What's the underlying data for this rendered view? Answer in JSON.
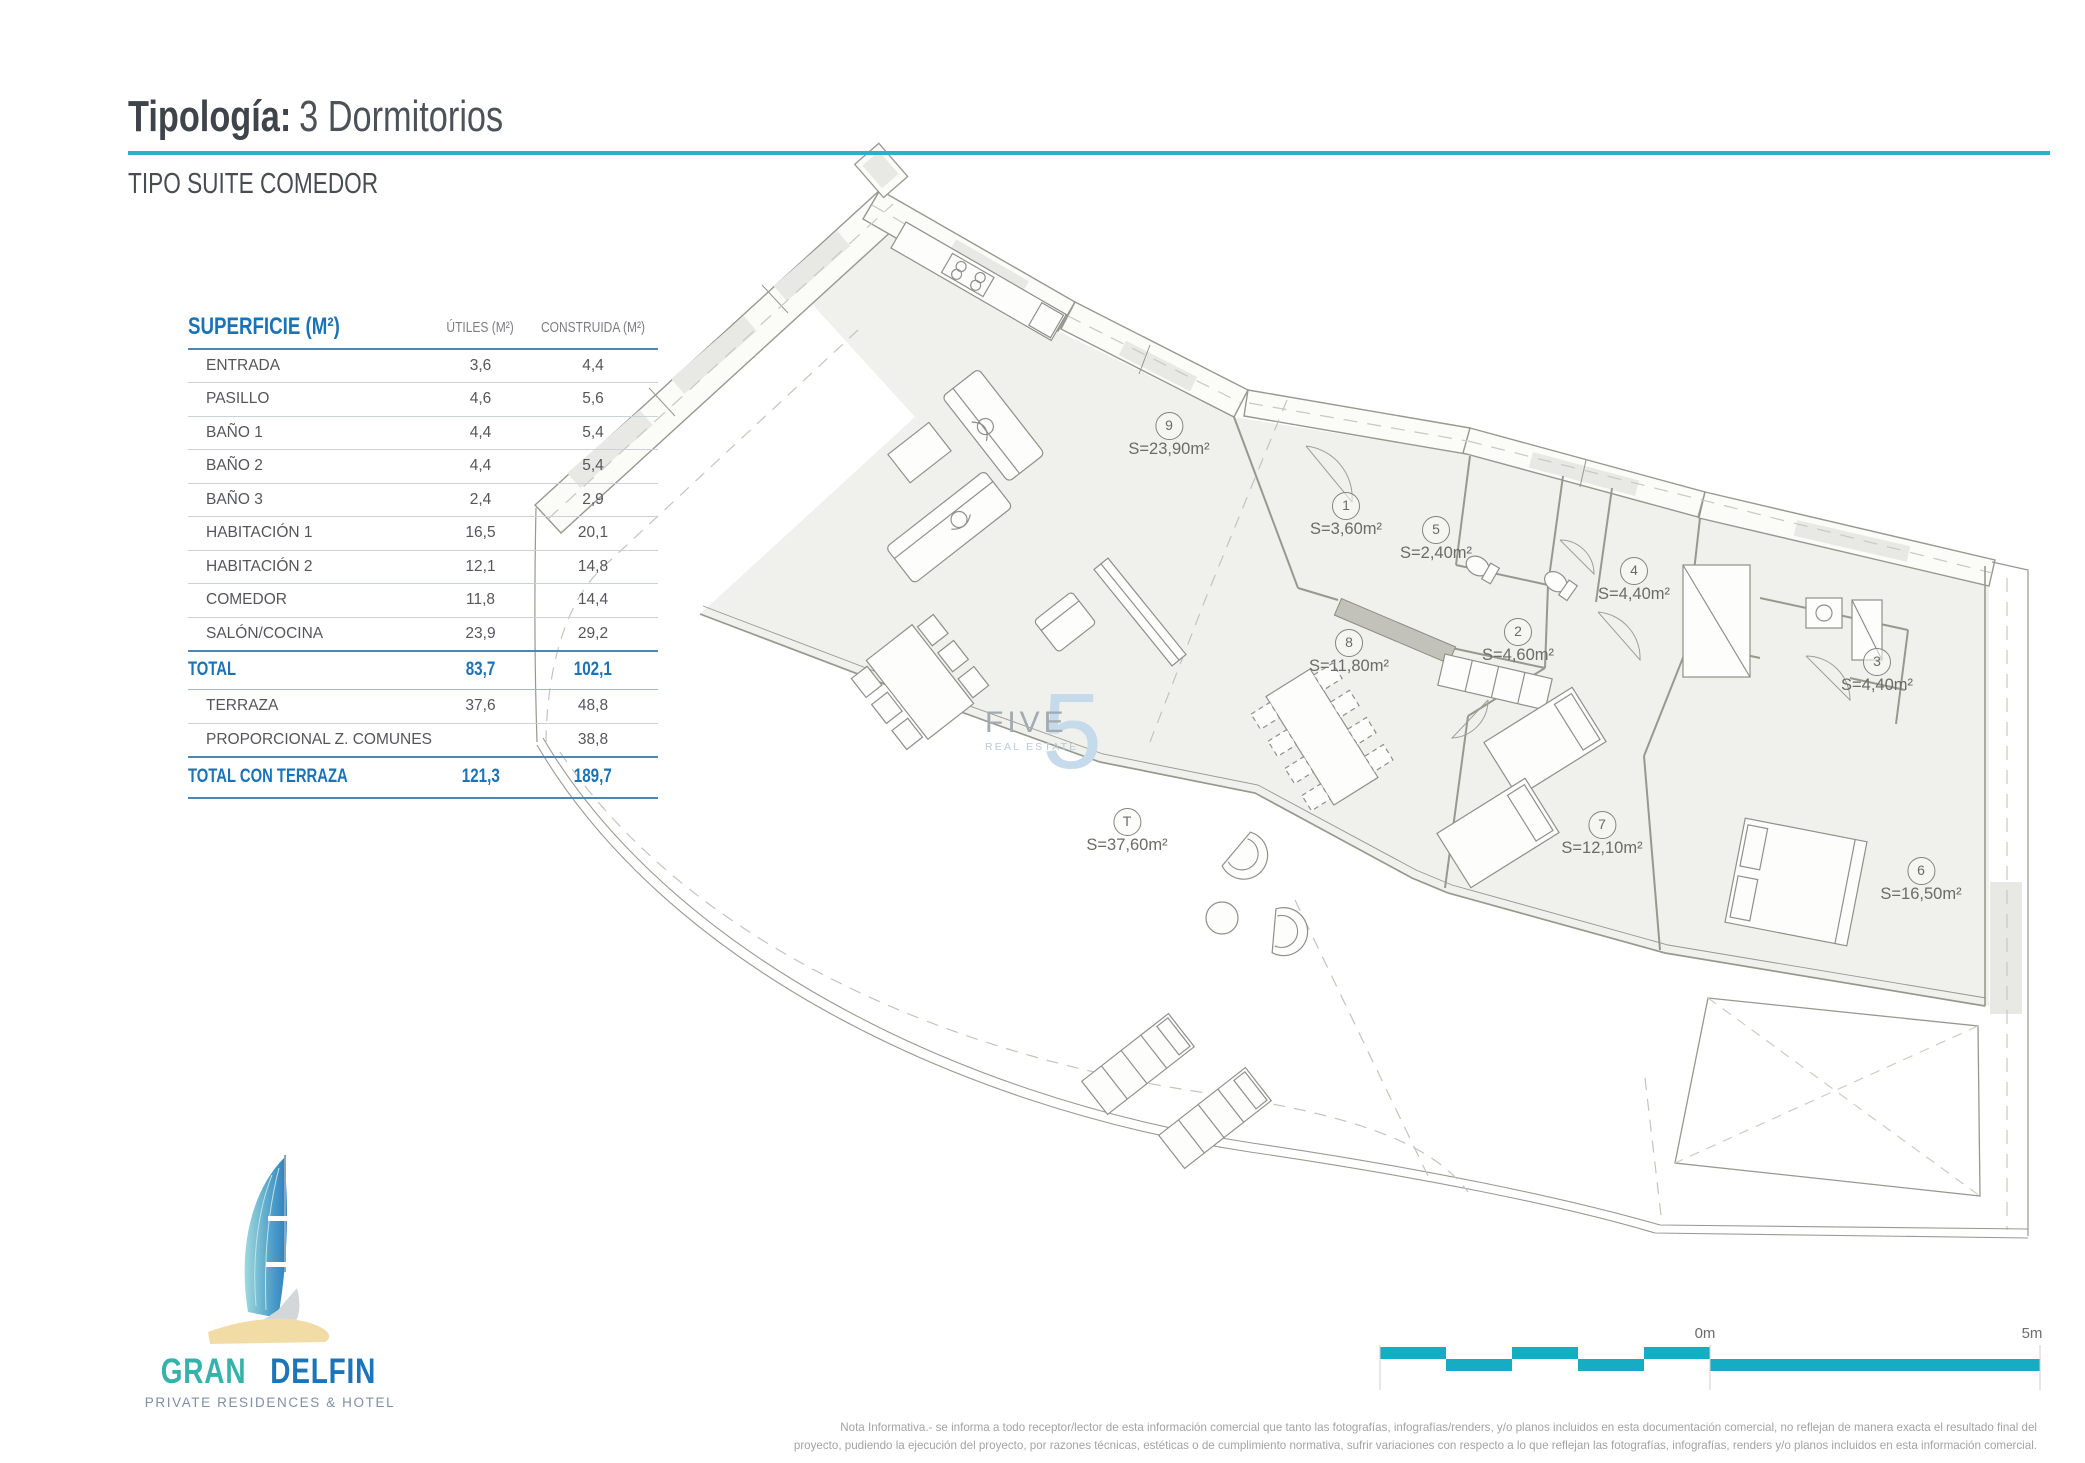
{
  "header": {
    "title_bold": "Tipología:",
    "title_rest": "3 Dormitorios",
    "subtitle": "TIPO SUITE COMEDOR"
  },
  "table": {
    "title": "SUPERFICIE (M²)",
    "col_utiles": "ÚTILES (M²)",
    "col_construida": "CONSTRUIDA (M²)",
    "rows": [
      {
        "label": "ENTRADA",
        "utiles": "3,6",
        "construida": "4,4"
      },
      {
        "label": "PASILLO",
        "utiles": "4,6",
        "construida": "5,6"
      },
      {
        "label": "BAÑO 1",
        "utiles": "4,4",
        "construida": "5,4"
      },
      {
        "label": "BAÑO 2",
        "utiles": "4,4",
        "construida": "5,4"
      },
      {
        "label": "BAÑO 3",
        "utiles": "2,4",
        "construida": "2,9"
      },
      {
        "label": "HABITACIÓN 1",
        "utiles": "16,5",
        "construida": "20,1"
      },
      {
        "label": "HABITACIÓN 2",
        "utiles": "12,1",
        "construida": "14,8"
      },
      {
        "label": "COMEDOR",
        "utiles": "11,8",
        "construida": "14,4"
      },
      {
        "label": "SALÓN/COCINA",
        "utiles": "23,9",
        "construida": "29,2"
      }
    ],
    "total": {
      "label": "TOTAL",
      "utiles": "83,7",
      "construida": "102,1"
    },
    "rows_extra": [
      {
        "label": "TERRAZA",
        "utiles": "37,6",
        "construida": "48,8"
      },
      {
        "label": "PROPORCIONAL Z. COMUNES",
        "utiles": "",
        "construida": "38,8"
      }
    ],
    "total_terraza": {
      "label": "TOTAL CON TERRAZA",
      "utiles": "121,3",
      "construida": "189,7"
    }
  },
  "plan": {
    "labels": [
      {
        "id": "9",
        "area": "S=23,90m²"
      },
      {
        "id": "1",
        "area": "S=3,60m²"
      },
      {
        "id": "5",
        "area": "S=2,40m²"
      },
      {
        "id": "4",
        "area": "S=4,40m²"
      },
      {
        "id": "2",
        "area": "S=4,60m²"
      },
      {
        "id": "3",
        "area": "S=4,40m²"
      },
      {
        "id": "8",
        "area": "S=11,80m²"
      },
      {
        "id": "7",
        "area": "S=12,10m²"
      },
      {
        "id": "T",
        "area": "S=37,60m²"
      },
      {
        "id": "6",
        "area": "S=16,50m²"
      }
    ],
    "watermark": {
      "line1": "FIVE",
      "line2": "REAL ESTATE",
      "big": "5"
    }
  },
  "scalebar": {
    "zero": "0m",
    "five": "5m"
  },
  "logo": {
    "gran": "GRAN",
    "delfin": "DELFIN",
    "subtitle": "PRIVATE RESIDENCES & HOTEL"
  },
  "disclaimer": {
    "line1": "Nota Informativa.- se informa a todo receptor/lector de esta información comercial que tanto las fotografías, infografías/renders, y/o planos incluidos en esta documentación comercial, no reflejan de manera exacta el resultado final del",
    "line2": "proyecto, pudiendo la ejecución del proyecto, por razones técnicas, estéticas o de cumplimiento normativa, sufrir variaciones con respecto a lo que reflejan las fotografías, infografías, renders y/o planos incluidos en esta información comercial."
  },
  "colors": {
    "accent_teal": "#27b2c6",
    "brand_blue": "#1a73b8",
    "plan_fill": "#f0f0ec"
  }
}
